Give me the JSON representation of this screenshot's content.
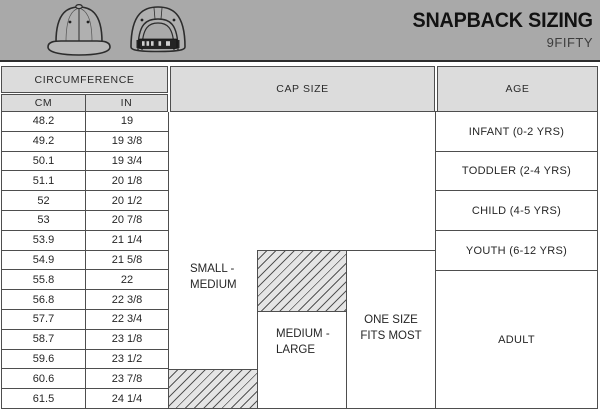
{
  "banner": {
    "title": "SNAPBACK SIZING",
    "subtitle": "9FIFTY"
  },
  "table": {
    "headers": {
      "circumference": "CIRCUMFERENCE",
      "cm": "CM",
      "inches": "IN",
      "cap_size": "CAP SIZE",
      "age": "AGE"
    },
    "rows": [
      {
        "cm": "48.2",
        "in": "19"
      },
      {
        "cm": "49.2",
        "in": "19 3/8"
      },
      {
        "cm": "50.1",
        "in": "19 3/4"
      },
      {
        "cm": "51.1",
        "in": "20 1/8"
      },
      {
        "cm": "52",
        "in": "20 1/2"
      },
      {
        "cm": "53",
        "in": "20 7/8"
      },
      {
        "cm": "53.9",
        "in": "21 1/4"
      },
      {
        "cm": "54.9",
        "in": "21 5/8"
      },
      {
        "cm": "55.8",
        "in": "22"
      },
      {
        "cm": "56.8",
        "in": "22 3/8"
      },
      {
        "cm": "57.7",
        "in": "22 3/4"
      },
      {
        "cm": "58.7",
        "in": "23 1/8"
      },
      {
        "cm": "59.6",
        "in": "23 1/2"
      },
      {
        "cm": "60.6",
        "in": "23 7/8"
      },
      {
        "cm": "61.5",
        "in": "24 1/4"
      }
    ],
    "cap_size": {
      "small_medium": "SMALL - MEDIUM",
      "medium_large": "MEDIUM - LARGE",
      "one_size": "ONE SIZE FITS MOST"
    },
    "age_groups": {
      "infant": "INFANT (0-2 YRS)",
      "toddler": "TODDLER (2-4 YRS)",
      "child": "CHILD (4-5 YRS)",
      "youth": "YOUTH (6-12 YRS)",
      "adult": "ADULT"
    }
  },
  "colors": {
    "banner_bg": "#a9a9a9",
    "header_cell_bg": "#dcdcdc",
    "border": "#4e4e4e",
    "hatch_bg": "#e5e5e5"
  }
}
